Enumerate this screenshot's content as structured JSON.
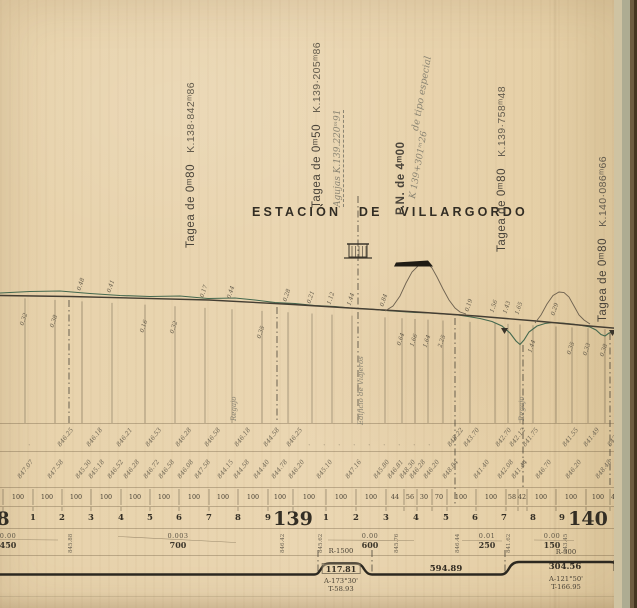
{
  "sheet": {
    "station_title": "ESTACIÓN DE VILLARGORDO"
  },
  "colors": {
    "paper": "#e8d3ad",
    "ink": "#3b352a",
    "faded_ink": "#6b6353",
    "terrain_green": "#44684e",
    "handwriting": "#8a8472",
    "edge_green": "#aeac92",
    "edge_brown": "#6e5c41",
    "edge_dark": "#443521"
  },
  "annotations": {
    "tageas": [
      {
        "name": "Tagea de 0ᵐ80",
        "km": "K.138·842ᵐ86",
        "x": 186,
        "bottom": 248
      },
      {
        "name": "Tagea de 0ᵐ50",
        "km": "K.139·205ᵐ86",
        "x": 312,
        "bottom": 208
      },
      {
        "name": "Tagea de 0ᵐ80",
        "km": "K.139·758ᵐ48",
        "x": 497,
        "bottom": 252
      },
      {
        "name": "Tagea de 0ᵐ80",
        "km": "K.140·086ᵐ66",
        "x": 598,
        "bottom": 322
      }
    ],
    "pn": {
      "title": "P.N. de 4ᵐ00",
      "note": "de tipo especial",
      "km": "K 139+301ᵐ26"
    },
    "agujas": "Agujas K.139.220ᵐ91",
    "edificio": "Edificio de Viajeros",
    "streams": [
      {
        "label": "Regajo",
        "x": 231
      },
      {
        "label": "Regajo",
        "x": 519
      },
      {
        "label": "Regajo",
        "x": 619
      }
    ]
  },
  "profile": {
    "ordinates": [
      {
        "x": 25,
        "v": "0.32"
      },
      {
        "x": 55,
        "v": "0.38"
      },
      {
        "x": 82,
        "v": "0.48",
        "up": 1
      },
      {
        "x": 112,
        "v": "0.41",
        "up": 1
      },
      {
        "x": 145,
        "v": "0.16"
      },
      {
        "x": 175,
        "v": "0.32"
      },
      {
        "x": 205,
        "v": "0.17",
        "up": 1
      },
      {
        "x": 232,
        "v": "0.44",
        "up": 1
      },
      {
        "x": 262,
        "v": "0.35"
      },
      {
        "x": 288,
        "v": "0.28",
        "up": 1
      },
      {
        "x": 312,
        "v": "0.21",
        "up": 1
      },
      {
        "x": 332,
        "v": "1.12",
        "up": 1
      },
      {
        "x": 352,
        "v": "1.44",
        "up": 1
      },
      {
        "x": 385,
        "v": "0.84",
        "up": 1
      },
      {
        "x": 402,
        "v": "0.64"
      },
      {
        "x": 415,
        "v": "1.66"
      },
      {
        "x": 428,
        "v": "1.64"
      },
      {
        "x": 443,
        "v": "2.25"
      },
      {
        "x": 470,
        "v": "0.19",
        "up": 1
      },
      {
        "x": 495,
        "v": "1.56",
        "up": 1
      },
      {
        "x": 508,
        "v": "1.43",
        "up": 1
      },
      {
        "x": 520,
        "v": "1.65",
        "up": 1
      },
      {
        "x": 533,
        "v": "1.44"
      },
      {
        "x": 556,
        "v": "0.29",
        "up": 1
      },
      {
        "x": 572,
        "v": "0.35"
      },
      {
        "x": 588,
        "v": "0.33"
      },
      {
        "x": 605,
        "v": "0.38"
      },
      {
        "x": 622,
        "v": "0.35"
      }
    ]
  },
  "table": {
    "terrain_elevations": [
      {
        "x": 32,
        "v": "·"
      },
      {
        "x": 62,
        "v": "846.25"
      },
      {
        "x": 91,
        "v": "846.18"
      },
      {
        "x": 121,
        "v": "846.21"
      },
      {
        "x": 150,
        "v": "846.53"
      },
      {
        "x": 180,
        "v": "846.28"
      },
      {
        "x": 209,
        "v": "846.58"
      },
      {
        "x": 239,
        "v": "846.18"
      },
      {
        "x": 268,
        "v": "844.58"
      },
      {
        "x": 291,
        "v": "846.25"
      },
      {
        "x": 312,
        "v": "·"
      },
      {
        "x": 327,
        "v": "·"
      },
      {
        "x": 342,
        "v": "·"
      },
      {
        "x": 357,
        "v": "·"
      },
      {
        "x": 372,
        "v": "·"
      },
      {
        "x": 387,
        "v": "·"
      },
      {
        "x": 402,
        "v": "·"
      },
      {
        "x": 417,
        "v": "·"
      },
      {
        "x": 432,
        "v": "·"
      },
      {
        "x": 452,
        "v": "848.22"
      },
      {
        "x": 468,
        "v": "843.70"
      },
      {
        "x": 500,
        "v": "842.70"
      },
      {
        "x": 514,
        "v": "842.12"
      },
      {
        "x": 527,
        "v": "841.75"
      },
      {
        "x": 567,
        "v": "841.55"
      },
      {
        "x": 588,
        "v": "841.49"
      },
      {
        "x": 612,
        "v": "843.43"
      }
    ],
    "grade_elevations": [
      {
        "x": 22,
        "v": "847.07"
      },
      {
        "x": 52,
        "v": "847.58"
      },
      {
        "x": 80,
        "v": "845.30"
      },
      {
        "x": 93,
        "v": "845.18"
      },
      {
        "x": 112,
        "v": "846.52"
      },
      {
        "x": 128,
        "v": "846.28"
      },
      {
        "x": 148,
        "v": "846.72"
      },
      {
        "x": 163,
        "v": "846.58"
      },
      {
        "x": 182,
        "v": "846.08"
      },
      {
        "x": 199,
        "v": "847.58"
      },
      {
        "x": 222,
        "v": "844.15"
      },
      {
        "x": 238,
        "v": "844.58"
      },
      {
        "x": 258,
        "v": "844.40"
      },
      {
        "x": 276,
        "v": "844.78"
      },
      {
        "x": 293,
        "v": "846.20"
      },
      {
        "x": 321,
        "v": "845.10"
      },
      {
        "x": 350,
        "v": "847.16"
      },
      {
        "x": 378,
        "v": "845.80"
      },
      {
        "x": 392,
        "v": "846.81"
      },
      {
        "x": 404,
        "v": "848.30"
      },
      {
        "x": 414,
        "v": "846.28"
      },
      {
        "x": 428,
        "v": "846.20"
      },
      {
        "x": 447,
        "v": "848.84"
      },
      {
        "x": 478,
        "v": "841.40"
      },
      {
        "x": 502,
        "v": "842.08"
      },
      {
        "x": 516,
        "v": "841.44"
      },
      {
        "x": 540,
        "v": "846.70"
      },
      {
        "x": 570,
        "v": "846.20"
      },
      {
        "x": 600,
        "v": "848.48"
      },
      {
        "x": 622,
        "v": "843.43"
      }
    ],
    "distances": {
      "ticks": [
        3,
        33,
        62,
        91,
        121,
        150,
        179,
        209,
        238,
        268,
        293,
        326,
        356,
        386,
        404,
        417,
        432,
        447,
        476,
        506,
        518,
        527,
        556,
        586,
        610,
        617,
        628
      ],
      "labels": [
        {
          "x": 18,
          "v": "100"
        },
        {
          "x": 47,
          "v": "100"
        },
        {
          "x": 76,
          "v": "100"
        },
        {
          "x": 106,
          "v": "100"
        },
        {
          "x": 135,
          "v": "100"
        },
        {
          "x": 164,
          "v": "100"
        },
        {
          "x": 194,
          "v": "100"
        },
        {
          "x": 223,
          "v": "100"
        },
        {
          "x": 253,
          "v": "100"
        },
        {
          "x": 280,
          "v": "100"
        },
        {
          "x": 309,
          "v": "100"
        },
        {
          "x": 341,
          "v": "100"
        },
        {
          "x": 371,
          "v": "100"
        },
        {
          "x": 395,
          "v": "44"
        },
        {
          "x": 410,
          "v": "56"
        },
        {
          "x": 424,
          "v": "30"
        },
        {
          "x": 439,
          "v": "70"
        },
        {
          "x": 461,
          "v": "100"
        },
        {
          "x": 491,
          "v": "100"
        },
        {
          "x": 512,
          "v": "58"
        },
        {
          "x": 522,
          "v": "42"
        },
        {
          "x": 541,
          "v": "100"
        },
        {
          "x": 571,
          "v": "100"
        },
        {
          "x": 598,
          "v": "100"
        },
        {
          "x": 613,
          "v": "4"
        },
        {
          "x": 623,
          "v": "96"
        }
      ]
    },
    "hectometers": [
      {
        "x": 3,
        "v": "8",
        "big": 1
      },
      {
        "x": 33,
        "v": "1"
      },
      {
        "x": 62,
        "v": "2"
      },
      {
        "x": 91,
        "v": "3"
      },
      {
        "x": 121,
        "v": "4"
      },
      {
        "x": 150,
        "v": "5"
      },
      {
        "x": 179,
        "v": "6"
      },
      {
        "x": 209,
        "v": "7"
      },
      {
        "x": 238,
        "v": "8"
      },
      {
        "x": 268,
        "v": "9"
      },
      {
        "x": 293,
        "v": "139",
        "big": 1
      },
      {
        "x": 326,
        "v": "1"
      },
      {
        "x": 356,
        "v": "2"
      },
      {
        "x": 386,
        "v": "3"
      },
      {
        "x": 416,
        "v": "4"
      },
      {
        "x": 446,
        "v": "5"
      },
      {
        "x": 475,
        "v": "6"
      },
      {
        "x": 504,
        "v": "7"
      },
      {
        "x": 533,
        "v": "8"
      },
      {
        "x": 562,
        "v": "9"
      },
      {
        "x": 588,
        "v": "140",
        "big": 1
      },
      {
        "x": 620,
        "v": "1"
      }
    ],
    "gradients": [
      {
        "slope": "0.00",
        "len": "450",
        "x": 8
      },
      {
        "slope": "0.003",
        "len": "700",
        "x": 178
      },
      {
        "slope": "0.00",
        "len": "600",
        "x": 370
      },
      {
        "slope": "0.01",
        "len": "250",
        "x": 487
      },
      {
        "slope": "0.00",
        "len": "150",
        "x": 552
      }
    ],
    "gradient_marks": [
      {
        "x": 68,
        "v": "845.88"
      },
      {
        "x": 280,
        "v": "846.42"
      },
      {
        "x": 318,
        "v": "845.62"
      },
      {
        "x": 394,
        "v": "845.76"
      },
      {
        "x": 455,
        "v": "846.44"
      },
      {
        "x": 506,
        "v": "841.62"
      },
      {
        "x": 563,
        "v": "843.45"
      },
      {
        "x": 627,
        "v": "843.15"
      }
    ],
    "alignment": {
      "straight_len": "594.89",
      "curve1": {
        "r": "R-1500",
        "len": "117.81",
        "a": "A-173°30'",
        "t": "T-58.93"
      },
      "curve2": {
        "r": "R-300",
        "len": "304.56",
        "a": "A-121°50'",
        "t": "T-166.95"
      },
      "right_partial": "104"
    }
  }
}
